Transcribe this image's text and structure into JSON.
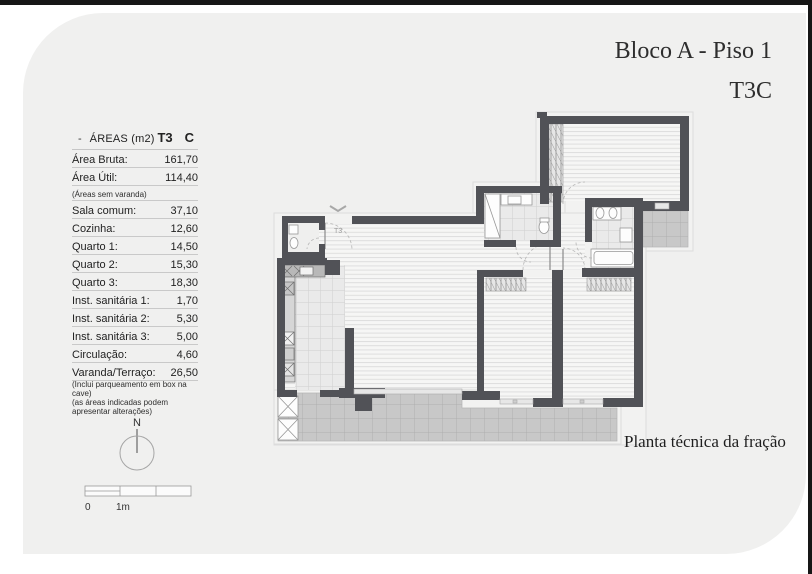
{
  "page": {
    "title_line1": "Bloco A - Piso 1",
    "title_line2": "T3C",
    "caption": "Planta técnica da fração"
  },
  "areas": {
    "header": {
      "dash": "-",
      "label": "ÁREAS (m2)",
      "type": "T3",
      "fraction": "C"
    },
    "rows": [
      {
        "kind": "data",
        "label": "Área Bruta:",
        "value": "161,70"
      },
      {
        "kind": "data",
        "label": "Área Útil:",
        "value": "114,40"
      },
      {
        "kind": "note",
        "label": "(Áreas sem varanda)",
        "value": ""
      },
      {
        "kind": "data",
        "label": "Sala comum:",
        "value": "37,10"
      },
      {
        "kind": "data",
        "label": "Cozinha:",
        "value": "12,60"
      },
      {
        "kind": "data",
        "label": "Quarto 1:",
        "value": "14,50"
      },
      {
        "kind": "data",
        "label": "Quarto 2:",
        "value": "15,30"
      },
      {
        "kind": "data",
        "label": "Quarto 3:",
        "value": "18,30"
      },
      {
        "kind": "data",
        "label": "Inst. sanitária 1:",
        "value": "1,70"
      },
      {
        "kind": "data",
        "label": "Inst. sanitária 2:",
        "value": "5,30"
      },
      {
        "kind": "data",
        "label": "Inst. sanitária 3:",
        "value": "5,00"
      },
      {
        "kind": "data",
        "label": "Circulação:",
        "value": "4,60"
      },
      {
        "kind": "data",
        "label": "Varanda/Terraço:",
        "value": "26,50"
      },
      {
        "kind": "noteplain",
        "label": "(Inclui parqueamento em box na cave)",
        "value": ""
      },
      {
        "kind": "noteplain",
        "label": "(as áreas indicadas podem apresentar alterações)",
        "value": ""
      }
    ]
  },
  "plan": {
    "entry_label": "T3"
  },
  "compass": {
    "label": "N"
  },
  "scalebar": {
    "zero": "0",
    "one_meter": "1m"
  },
  "colors": {
    "wall": "#515257",
    "sheet": "#f0f0ef",
    "terrace": "#c8c8c8",
    "frame": "#161616"
  }
}
